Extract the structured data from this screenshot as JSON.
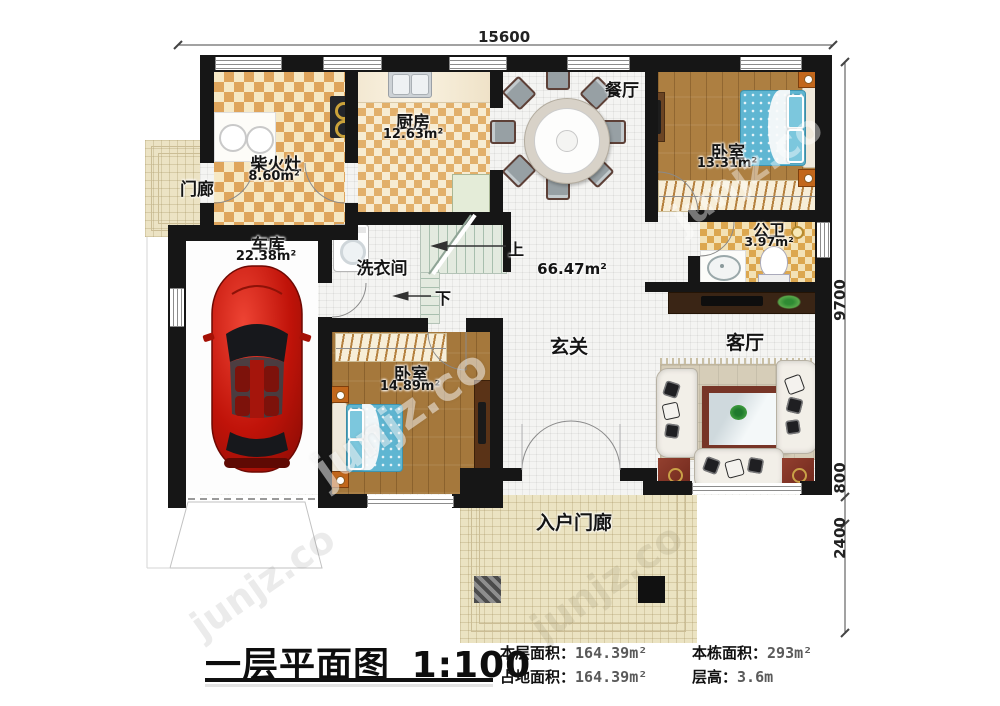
{
  "title": {
    "main": "一层平面图",
    "scale": "1:100"
  },
  "stats": {
    "floor_label": "本层面积：",
    "floor_value": "164.39m²",
    "building_label": "本栋面积：",
    "building_value": "293m²",
    "land_label": "占地面积：",
    "land_value": "164.39m²",
    "height_label": "层高：",
    "height_value": "3.6m"
  },
  "dimensions": {
    "top": "15600",
    "right_total": "9700",
    "right_mid": "800",
    "right_bottom": "2400"
  },
  "rooms": {
    "firewood_kitchen": {
      "name": "柴火灶",
      "area": "8.60m²"
    },
    "kitchen": {
      "name": "厨房",
      "area": "12.63m²"
    },
    "dining": {
      "name": "餐厅"
    },
    "bedroom_top": {
      "name": "卧室",
      "area": "13.31m²"
    },
    "bathroom": {
      "name": "公卫",
      "area": "3.97m²"
    },
    "garage": {
      "name": "车库",
      "area": "22.38m²"
    },
    "laundry": {
      "name": "洗衣间"
    },
    "hall": {
      "name": "玄关",
      "area": "66.47m²"
    },
    "living": {
      "name": "客厅"
    },
    "bedroom_bottom": {
      "name": "卧室",
      "area": "14.89m²"
    },
    "side_porch": {
      "name": "门廊"
    },
    "entry_porch": {
      "name": "入户门廊"
    }
  },
  "stairs": {
    "up": "上",
    "down": "下"
  },
  "watermark": {
    "text": "junjz.co"
  },
  "colors": {
    "wall": "#161616",
    "checker": "#dfa55c",
    "wood": "#ad7f41",
    "bed": "#5fb6d2",
    "car": "#c41b12",
    "table": "#84352a"
  }
}
